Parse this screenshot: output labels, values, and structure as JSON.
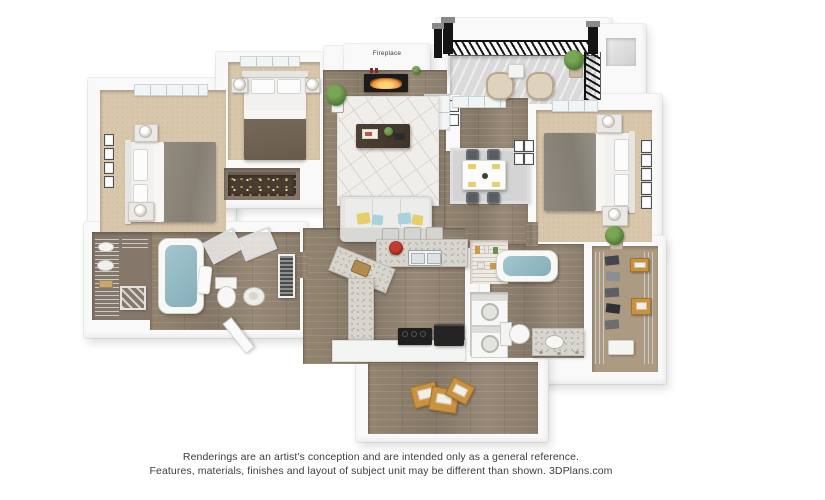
{
  "image_type": "3d-floor-plan-rendering",
  "plan": {
    "labels": {
      "fireplace": "Fireplace"
    },
    "rooms": [
      {
        "name": "bedroom-1",
        "floor": "carpet",
        "contents": [
          "bed",
          "two-nightstands",
          "table-lamps",
          "wall-art",
          "window"
        ]
      },
      {
        "name": "bedroom-2",
        "floor": "carpet",
        "contents": [
          "bed",
          "two-nightstands",
          "window",
          "reach-in-closet-shelf"
        ]
      },
      {
        "name": "living-room",
        "floor": "hardwood",
        "contents": [
          "sofa-with-pillows",
          "coffee-table",
          "geometric-area-rug",
          "fireplace",
          "potted-plant",
          "balcony-glass-door"
        ]
      },
      {
        "name": "dining-area",
        "floor": "hardwood",
        "contents": [
          "dining-table",
          "four-chairs",
          "area-rug",
          "wall-art"
        ]
      },
      {
        "name": "bedroom-3-master",
        "floor": "carpet",
        "contents": [
          "bed",
          "two-nightstands",
          "wall-art",
          "potted-plant",
          "window"
        ]
      },
      {
        "name": "kitchen",
        "floor": "hardwood",
        "contents": [
          "granite-bar-counter",
          "double-sink",
          "fruit-bowl",
          "cutting-board",
          "range",
          "black-refrigerator",
          "three-bar-stools"
        ]
      },
      {
        "name": "pantry-and-laundry",
        "floor": "hardwood",
        "contents": [
          "wire-shelving",
          "stacked-washer-dryer"
        ]
      },
      {
        "name": "bathroom-1",
        "floor": "hardwood",
        "contents": [
          "bathtub",
          "glass-shower-panels",
          "toilet",
          "pedestal-sink",
          "towel"
        ]
      },
      {
        "name": "bathroom-2",
        "floor": "hardwood",
        "contents": [
          "bathtub",
          "toilet",
          "granite-vanity-sink"
        ]
      },
      {
        "name": "walk-in-closet-1",
        "floor": "hardwood",
        "contents": [
          "wire-shelving",
          "baskets"
        ]
      },
      {
        "name": "walk-in-closet-2",
        "floor": "carpet",
        "contents": [
          "wire-shelving",
          "hanging-clothes",
          "storage-boxes",
          "bin"
        ]
      },
      {
        "name": "balcony",
        "floor": "concrete",
        "contents": [
          "black-metal-railing",
          "two-patio-chairs",
          "side-table",
          "potted-plant"
        ]
      },
      {
        "name": "storage-room",
        "floor": "hardwood",
        "contents": [
          "moving-boxes"
        ]
      },
      {
        "name": "hallway",
        "floor": "hardwood",
        "contents": [
          "entry-door",
          "louvered-utility-door"
        ]
      }
    ],
    "palette": {
      "background": "#ffffff",
      "wall": "#f9f9f9",
      "hardwood": "#8c7e6d",
      "carpet": "#d9c7ab",
      "granite": "#d8d5ce",
      "bath_water": "#8fb9c5",
      "railing": "#171717",
      "flame": "#f09030",
      "cardboard_box": "#ca9140",
      "pillow_yellow": "#e5cf6a",
      "pillow_blue": "#a9d2dd",
      "fruit_bowl_red": "#a32020"
    }
  },
  "caption": {
    "line1": "Renderings are an artist's conception and are intended only as a general reference.",
    "line2": "Features, materials, finishes and layout of subject unit may be different than shown. 3DPlans.com",
    "brand": "3DPlans.com"
  }
}
